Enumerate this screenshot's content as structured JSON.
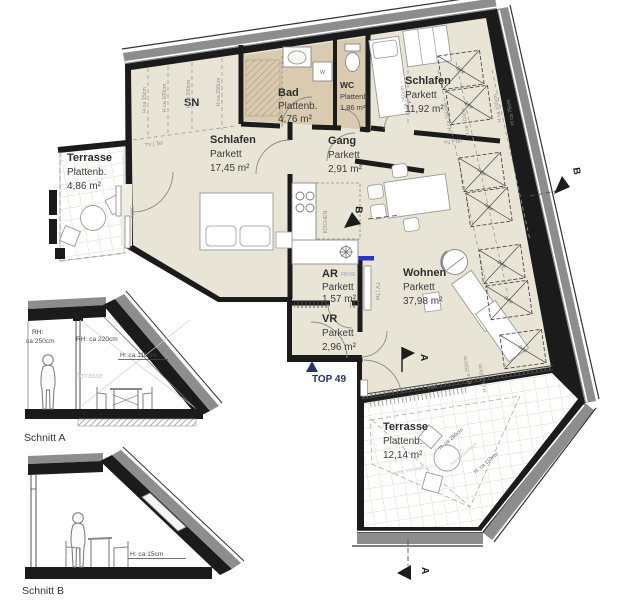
{
  "plan": {
    "unit_label": "TOP 49",
    "rooms": [
      {
        "name": "Terrasse",
        "floor": "Plattenb.",
        "area": "4,86 m²"
      },
      {
        "name": "SN"
      },
      {
        "name": "Schlafen",
        "floor": "Parkett",
        "area": "17,45 m²"
      },
      {
        "name": "Bad",
        "floor": "Plattenb.",
        "area": "4,76 m²"
      },
      {
        "name": "WC",
        "floor": "Plattenb.",
        "area": "1,86 m²"
      },
      {
        "name": "Schlafen",
        "floor": "Parkett",
        "area": "11,92 m²"
      },
      {
        "name": "Gang",
        "floor": "Parkett",
        "area": "2,91 m²"
      },
      {
        "name": "Wohnen",
        "floor": "Parkett",
        "area": "37,98 m²"
      },
      {
        "name": "AR",
        "floor": "Parkett",
        "area": "1,57 m²",
        "tag": "FBH/E"
      },
      {
        "name": "VR",
        "floor": "Parkett",
        "area": "2,96 m²"
      },
      {
        "name": "Terrasse",
        "floor": "Plattenb.",
        "area": "12,14 m²"
      }
    ],
    "annotations": {
      "kochen": "KOCHEN",
      "washer": "W",
      "tv_tel": "TV | Tel",
      "stufe": "Stufe",
      "fix": "FIX",
      "dff": "DFF",
      "kante_vordach": "Kante Vordach",
      "h15": "H ca 15cm",
      "h75": "H ca 75cm",
      "h100": "H ca 100cm",
      "h200": "H ca 200cm",
      "h250": "H ca 250cm",
      "h280": "H. ca 280cm",
      "h110": "H. ca 110cm"
    },
    "section_markers": {
      "a": "A",
      "b": "B"
    }
  },
  "sections": {
    "a": {
      "title": "Schnitt A",
      "rh_label": "RH:",
      "rh_left": "ca 250cm",
      "rh_right": "RH: ca 220cm",
      "h_terrace": "H: ca 110cm",
      "terrace": "Terrasse"
    },
    "b": {
      "title": "Schnitt B",
      "h_floor": "H: ca 15cm"
    }
  },
  "colors": {
    "floor_parquet": "#e9e5d6",
    "floor_wet": "#d9cab0",
    "wall": "#1b1b1b",
    "roof_band": "#8d8d8d",
    "accent_blue": "#2a35c8",
    "navy": "#27336e"
  }
}
